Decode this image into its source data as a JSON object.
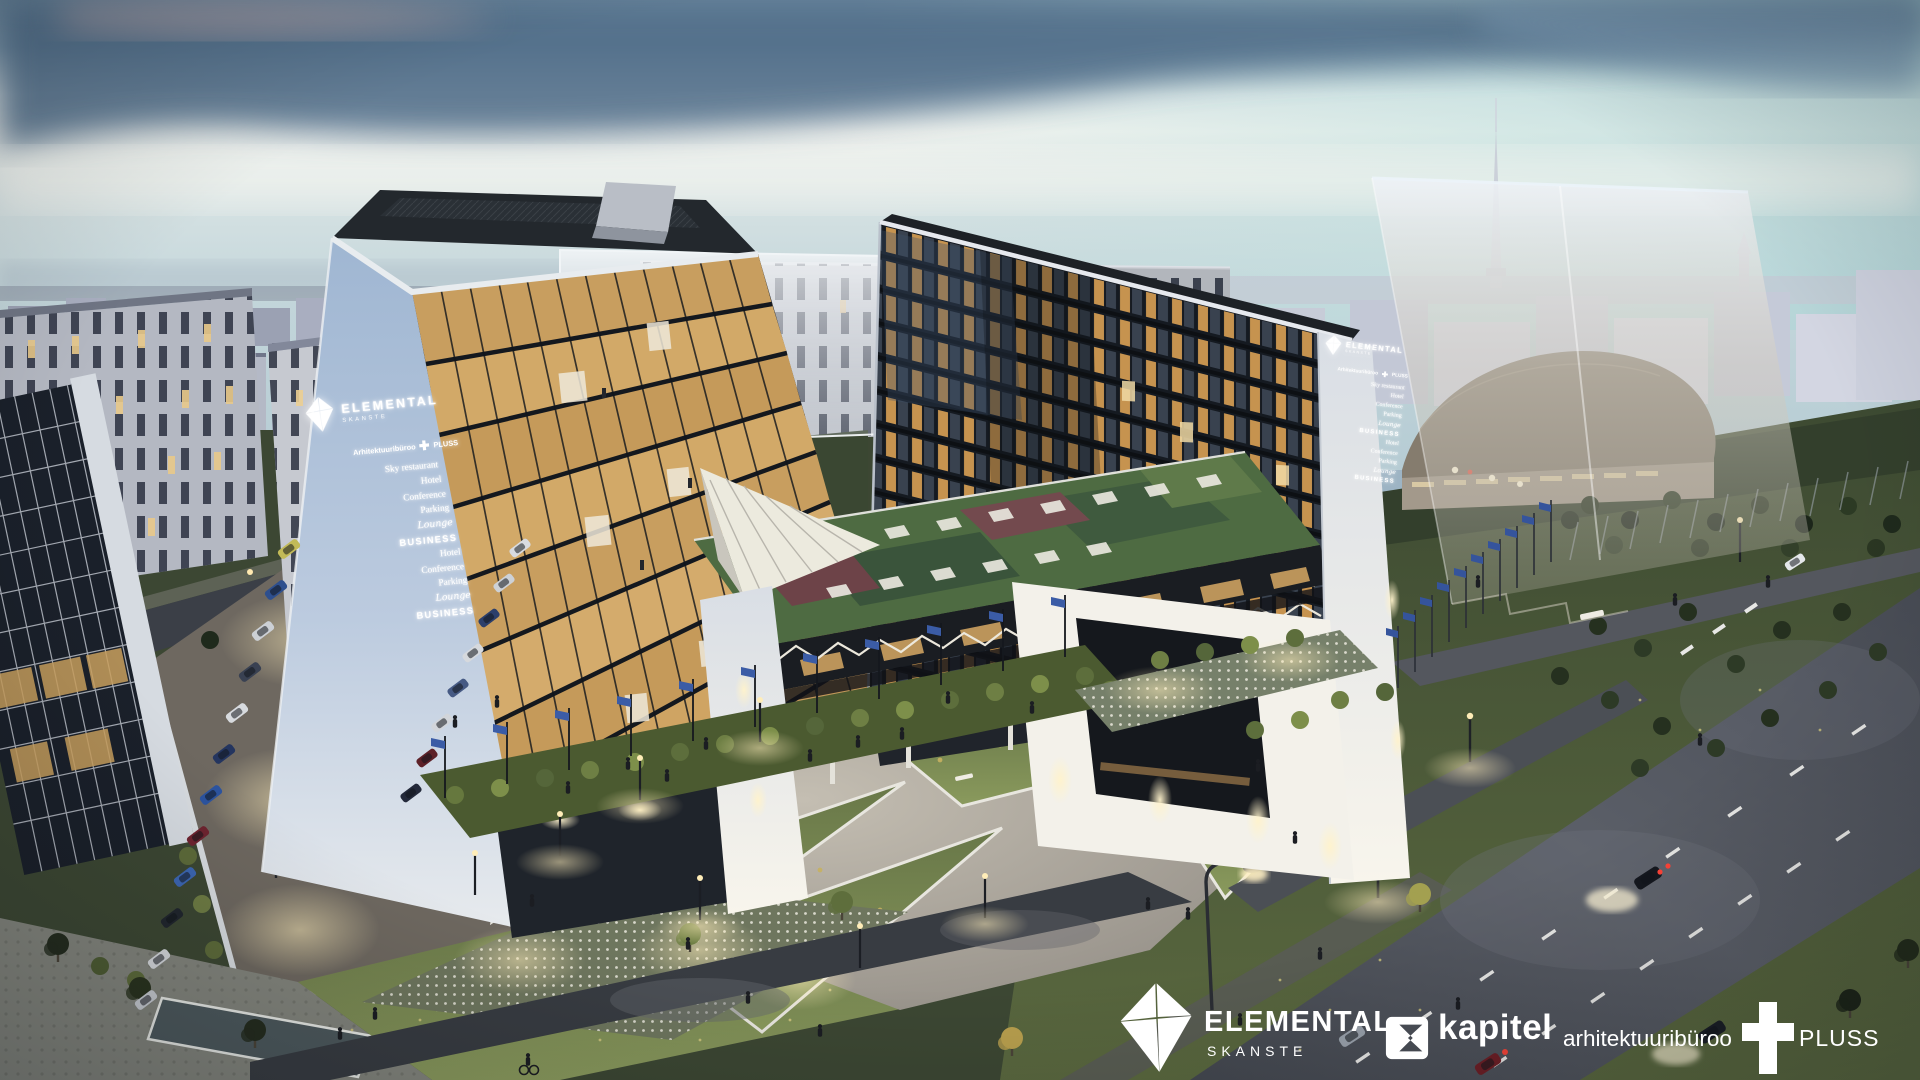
{
  "scene": {
    "title": "Elemental Skanste aerial dusk architectural rendering",
    "palette": {
      "sky_top": "#7b95a9",
      "cloud": "#4e6a86",
      "horizon_glow": "#eef1ee",
      "sky_teal": "#bfdfdf",
      "city_far": "#b7bccb",
      "white_wall": "#e9edf2",
      "signage_wall": "#aac0da",
      "glass_warm": "#d2a766",
      "glass_dark": "#1b2027",
      "roof": "#2e343b",
      "green_roof": "#52683f",
      "lawn": "#4c5938",
      "lawn_lit": "#7e8c55",
      "paving": "#b3ada3",
      "road": "#51555e",
      "hedge": "#66743f",
      "flag_blue": "#3a5aa0",
      "light_warm": "#ffeec0"
    }
  },
  "signage": {
    "brand": "ELEMENTAL",
    "brand_sub": "SKANSTE",
    "architect_prefix": "Arhitektuuribüroo",
    "architect_suffix": "PLUSS",
    "items": [
      "Sky restaurant",
      "Hotel",
      "Conference",
      "Parking",
      "Lounge",
      "BUSINESS",
      "Hotel",
      "Conference",
      "Parking",
      "Lounge",
      "BUSINESS"
    ]
  },
  "footer": {
    "elemental": {
      "title": "ELEMENTAL",
      "subtitle": "SKANSTE"
    },
    "kapitel": {
      "label": "kapitel"
    },
    "architect": {
      "prefix": "arhitektuuribüroo",
      "suffix": "PLUSS"
    }
  }
}
